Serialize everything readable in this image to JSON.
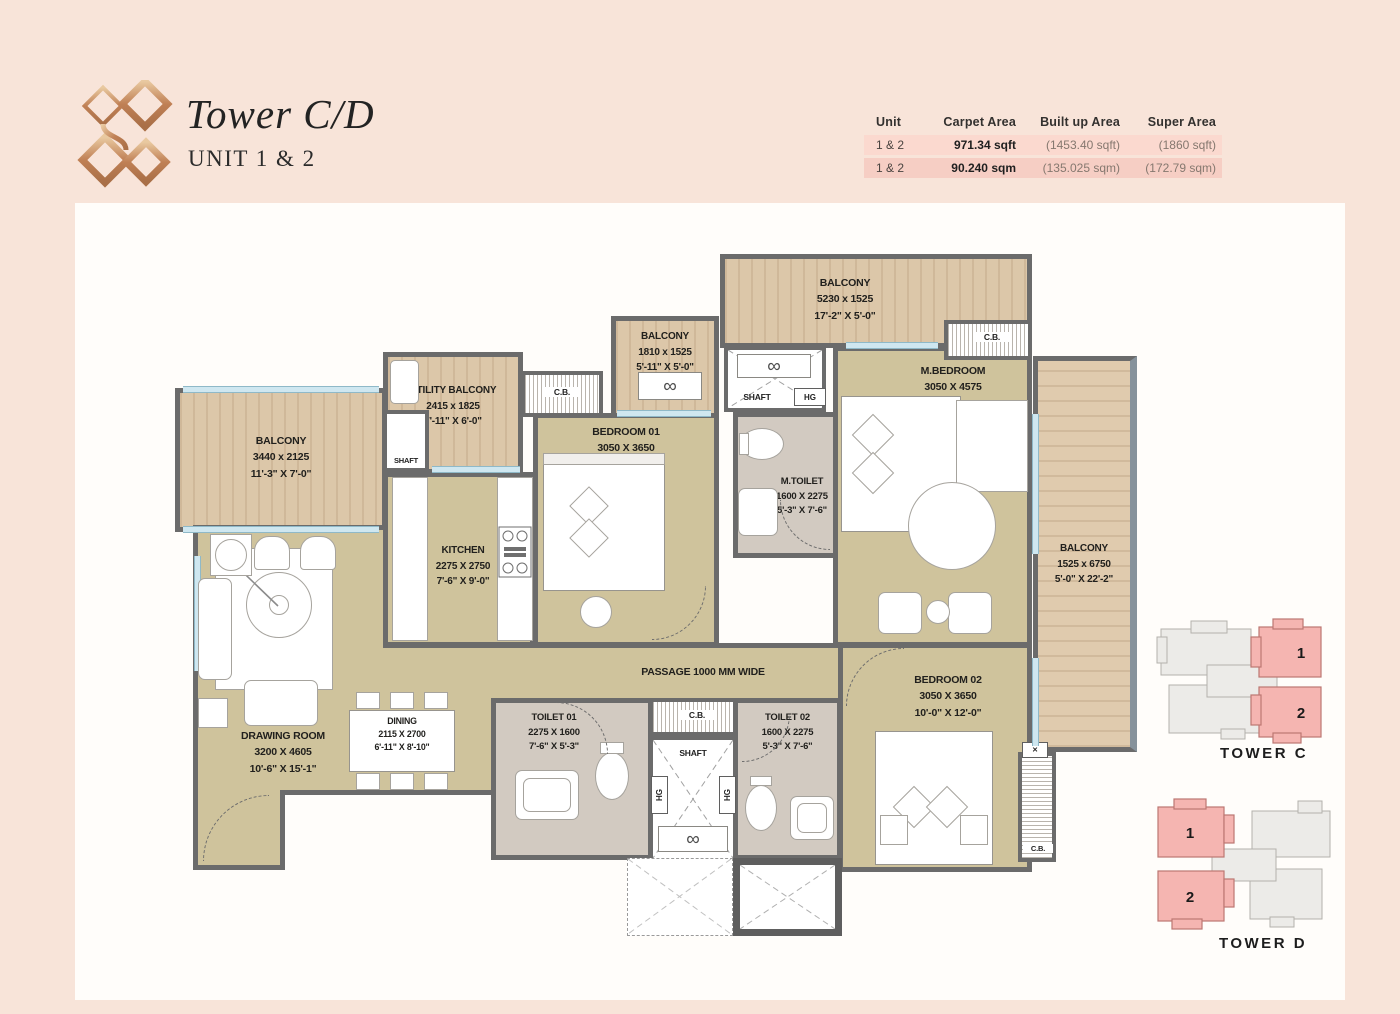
{
  "header": {
    "brand_title": "Tower C/D",
    "brand_subtitle": "UNIT 1 & 2"
  },
  "area_table": {
    "headers": [
      "Unit",
      "Carpet Area",
      "Built up Area",
      "Super Area"
    ],
    "rows": [
      {
        "unit": "1 & 2",
        "carpet": "971.34 sqft",
        "built": "(1453.40 sqft)",
        "super": "(1860 sqft)"
      },
      {
        "unit": "1 & 2",
        "carpet": "90.240 sqm",
        "built": "(135.025 sqm)",
        "super": "(172.79 sqm)"
      }
    ]
  },
  "rooms": {
    "balcony_left": {
      "name": "BALCONY",
      "mm": "3440 x 2125",
      "ft": "11'-3\" X 7'-0\""
    },
    "drawing_room": {
      "name": "DRAWING ROOM",
      "mm": "3200 X 4605",
      "ft": "10'-6\" X 15'-1\""
    },
    "dining": {
      "name": "DINING",
      "mm": "2115 X 2700",
      "ft": "6'-11\" X 8'-10\""
    },
    "kitchen": {
      "name": "KITCHEN",
      "mm": "2275 X 2750",
      "ft": "7'-6\" X 9'-0\""
    },
    "utility_balcony": {
      "name": "UTILITY BALCONY",
      "mm": "2415 x 1825",
      "ft": "7'-11\" X 6'-0\""
    },
    "bedroom_01": {
      "name": "BEDROOM 01",
      "mm": "3050 X 3650",
      "ft": "10'-0\" X 12'-0\""
    },
    "balcony_mid": {
      "name": "BALCONY",
      "mm": "1810 x 1525",
      "ft": "5'-11\" X 5'-0\""
    },
    "balcony_top": {
      "name": "BALCONY",
      "mm": "5230 x 1525",
      "ft": "17'-2\" X 5'-0\""
    },
    "m_bedroom": {
      "name": "M.BEDROOM",
      "mm": "3050 X 4575",
      "ft": "10'-0\" X 15'-0\""
    },
    "m_toilet": {
      "name": "M.TOILET",
      "mm": "1600 X 2275",
      "ft": "5'-3\" X 7'-6\""
    },
    "balcony_right": {
      "name": "BALCONY",
      "mm": "1525 x 6750",
      "ft": "5'-0\" X 22'-2\""
    },
    "toilet_01": {
      "name": "TOILET 01",
      "mm": "2275 X 1600",
      "ft": "7'-6\" X 5'-3\""
    },
    "toilet_02": {
      "name": "TOILET 02",
      "mm": "1600 X 2275",
      "ft": "5'-3\" X 7'-6\""
    },
    "bedroom_02": {
      "name": "BEDROOM 02",
      "mm": "3050 X 3650",
      "ft": "10'-0\" X 12'-0\""
    }
  },
  "plan_labels": {
    "passage": "PASSAGE 1000 MM WIDE",
    "shaft": "SHAFT",
    "cb": "C.B.",
    "hg": "HG"
  },
  "icons": {
    "fan": "∞",
    "cross": "✕"
  },
  "keyplans": {
    "tower_c": {
      "caption": "TOWER C",
      "unit1": "1",
      "unit2": "2"
    },
    "tower_d": {
      "caption": "TOWER D",
      "unit1": "1",
      "unit2": "2"
    }
  },
  "colors": {
    "page_bg": "#f8e4d9",
    "accent_copper": "#c08055",
    "unit_pink": "#f5b5b1",
    "wall_gray": "#6b6b6b",
    "wood": "#dcc7a9",
    "room_khaki": "#cfc39c"
  }
}
